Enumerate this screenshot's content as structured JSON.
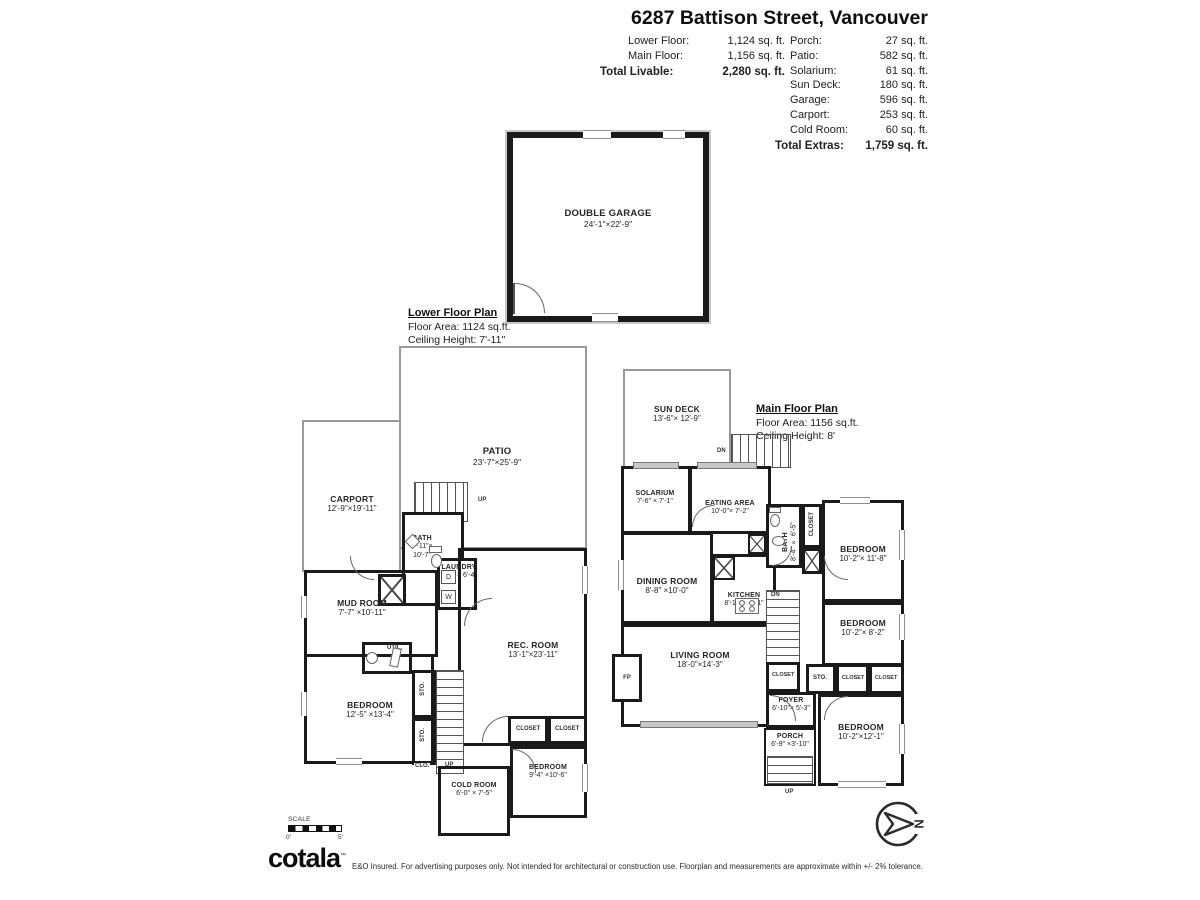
{
  "header": {
    "title": "6287 Battison Street, Vancouver",
    "left_stats": [
      {
        "label": "Lower Floor:",
        "value": "1,124 sq. ft."
      },
      {
        "label": "Main Floor:",
        "value": "1,156 sq. ft."
      }
    ],
    "total_livable_label": "Total Livable:",
    "total_livable_value": "2,280 sq. ft.",
    "right_stats": [
      {
        "label": "Porch:",
        "value": "27 sq. ft."
      },
      {
        "label": "Patio:",
        "value": "582 sq. ft."
      },
      {
        "label": "Solarium:",
        "value": "61 sq. ft."
      },
      {
        "label": "Sun Deck:",
        "value": "180 sq. ft."
      },
      {
        "label": "Garage:",
        "value": "596 sq. ft."
      },
      {
        "label": "Carport:",
        "value": "253 sq. ft."
      },
      {
        "label": "Cold Room:",
        "value": "60 sq. ft."
      }
    ],
    "total_extras_label": "Total Extras:",
    "total_extras_value": "1,759 sq. ft."
  },
  "common": {
    "closet": "CLOSET",
    "sto": "STO.",
    "clo": "CLO.",
    "up": "UP",
    "dn": "DN",
    "fp": "FP",
    "util": "UTIL.",
    "washer": "W",
    "dryer": "D"
  },
  "garage_plan": {
    "room": {
      "name": "DOUBLE GARAGE",
      "dims": "24'-1\"×22'-9\""
    }
  },
  "lower_plan": {
    "title": "Lower Floor Plan",
    "area": "Floor Area: 1124 sq.ft.",
    "ceiling": "Ceiling Height: 7'-11\"",
    "rooms": {
      "patio": {
        "name": "PATIO",
        "dims": "23'-7\"×25'-9\""
      },
      "carport": {
        "name": "CARPORT",
        "dims": "12'-9\"×19'-11\""
      },
      "bath": {
        "name": "BATH",
        "dims": "8'-11\"× 10'-7\""
      },
      "laundry": {
        "name": "LAUNDRY",
        "dims": "5'-3\" × 6'-4\""
      },
      "mud_room": {
        "name": "MUD ROOM",
        "dims": "7'-7\" ×10'-11\""
      },
      "rec_room": {
        "name": "REC. ROOM",
        "dims": "13'-1\"×23'-11\""
      },
      "bedroom1": {
        "name": "BEDROOM",
        "dims": "12'-5\" ×13'-4\""
      },
      "cold_room": {
        "name": "COLD ROOM",
        "dims": "6'-0\" × 7'-5\""
      },
      "bedroom2": {
        "name": "BEDROOM",
        "dims": "9'-4\" ×10'-6\""
      }
    }
  },
  "main_plan": {
    "title": "Main Floor Plan",
    "area": "Floor Area: 1156 sq.ft.",
    "ceiling": "Ceiling Height: 8'",
    "rooms": {
      "sun_deck": {
        "name": "SUN DECK",
        "dims": "13'-6\"× 12'-9\""
      },
      "solarium": {
        "name": "SOLARIUM",
        "dims": "7'-6\" × 7'-1\""
      },
      "eating_area": {
        "name": "EATING AREA",
        "dims": "10'-0\"× 7'-2\""
      },
      "dining_room": {
        "name": "DINING ROOM",
        "dims": "8'-8\" ×10'-0\""
      },
      "kitchen": {
        "name": "KITCHEN",
        "dims": "8'-11\"×10'-1\""
      },
      "bath": {
        "name": "BATH",
        "dims": "8'-4\" × 6'-5\""
      },
      "bedroom_ne": {
        "name": "BEDROOM",
        "dims": "10'-2\"× 11'-8\""
      },
      "bedroom_e": {
        "name": "BEDROOM",
        "dims": "10'-2\"× 8'-2\""
      },
      "living_room": {
        "name": "LIVING ROOM",
        "dims": "18'-0\"×14'-3\""
      },
      "foyer": {
        "name": "FOYER",
        "dims": "6'-10\"× 5'-3\""
      },
      "bedroom_se": {
        "name": "BEDROOM",
        "dims": "10'-2\"×12'-1\""
      },
      "porch": {
        "name": "PORCH",
        "dims": "6'-9\" ×3'-10\""
      }
    }
  },
  "footer": {
    "scale_label": "SCALE",
    "scale_start": "0'",
    "scale_end": "5'",
    "brand": "cotala",
    "brand_tm": "™",
    "disclaimer": "E&O Insured. For advertising purposes only. Not intended for architectural or construction use. Floorplan and measurements are approximate within +/- 2% tolerance.",
    "north": "N"
  }
}
